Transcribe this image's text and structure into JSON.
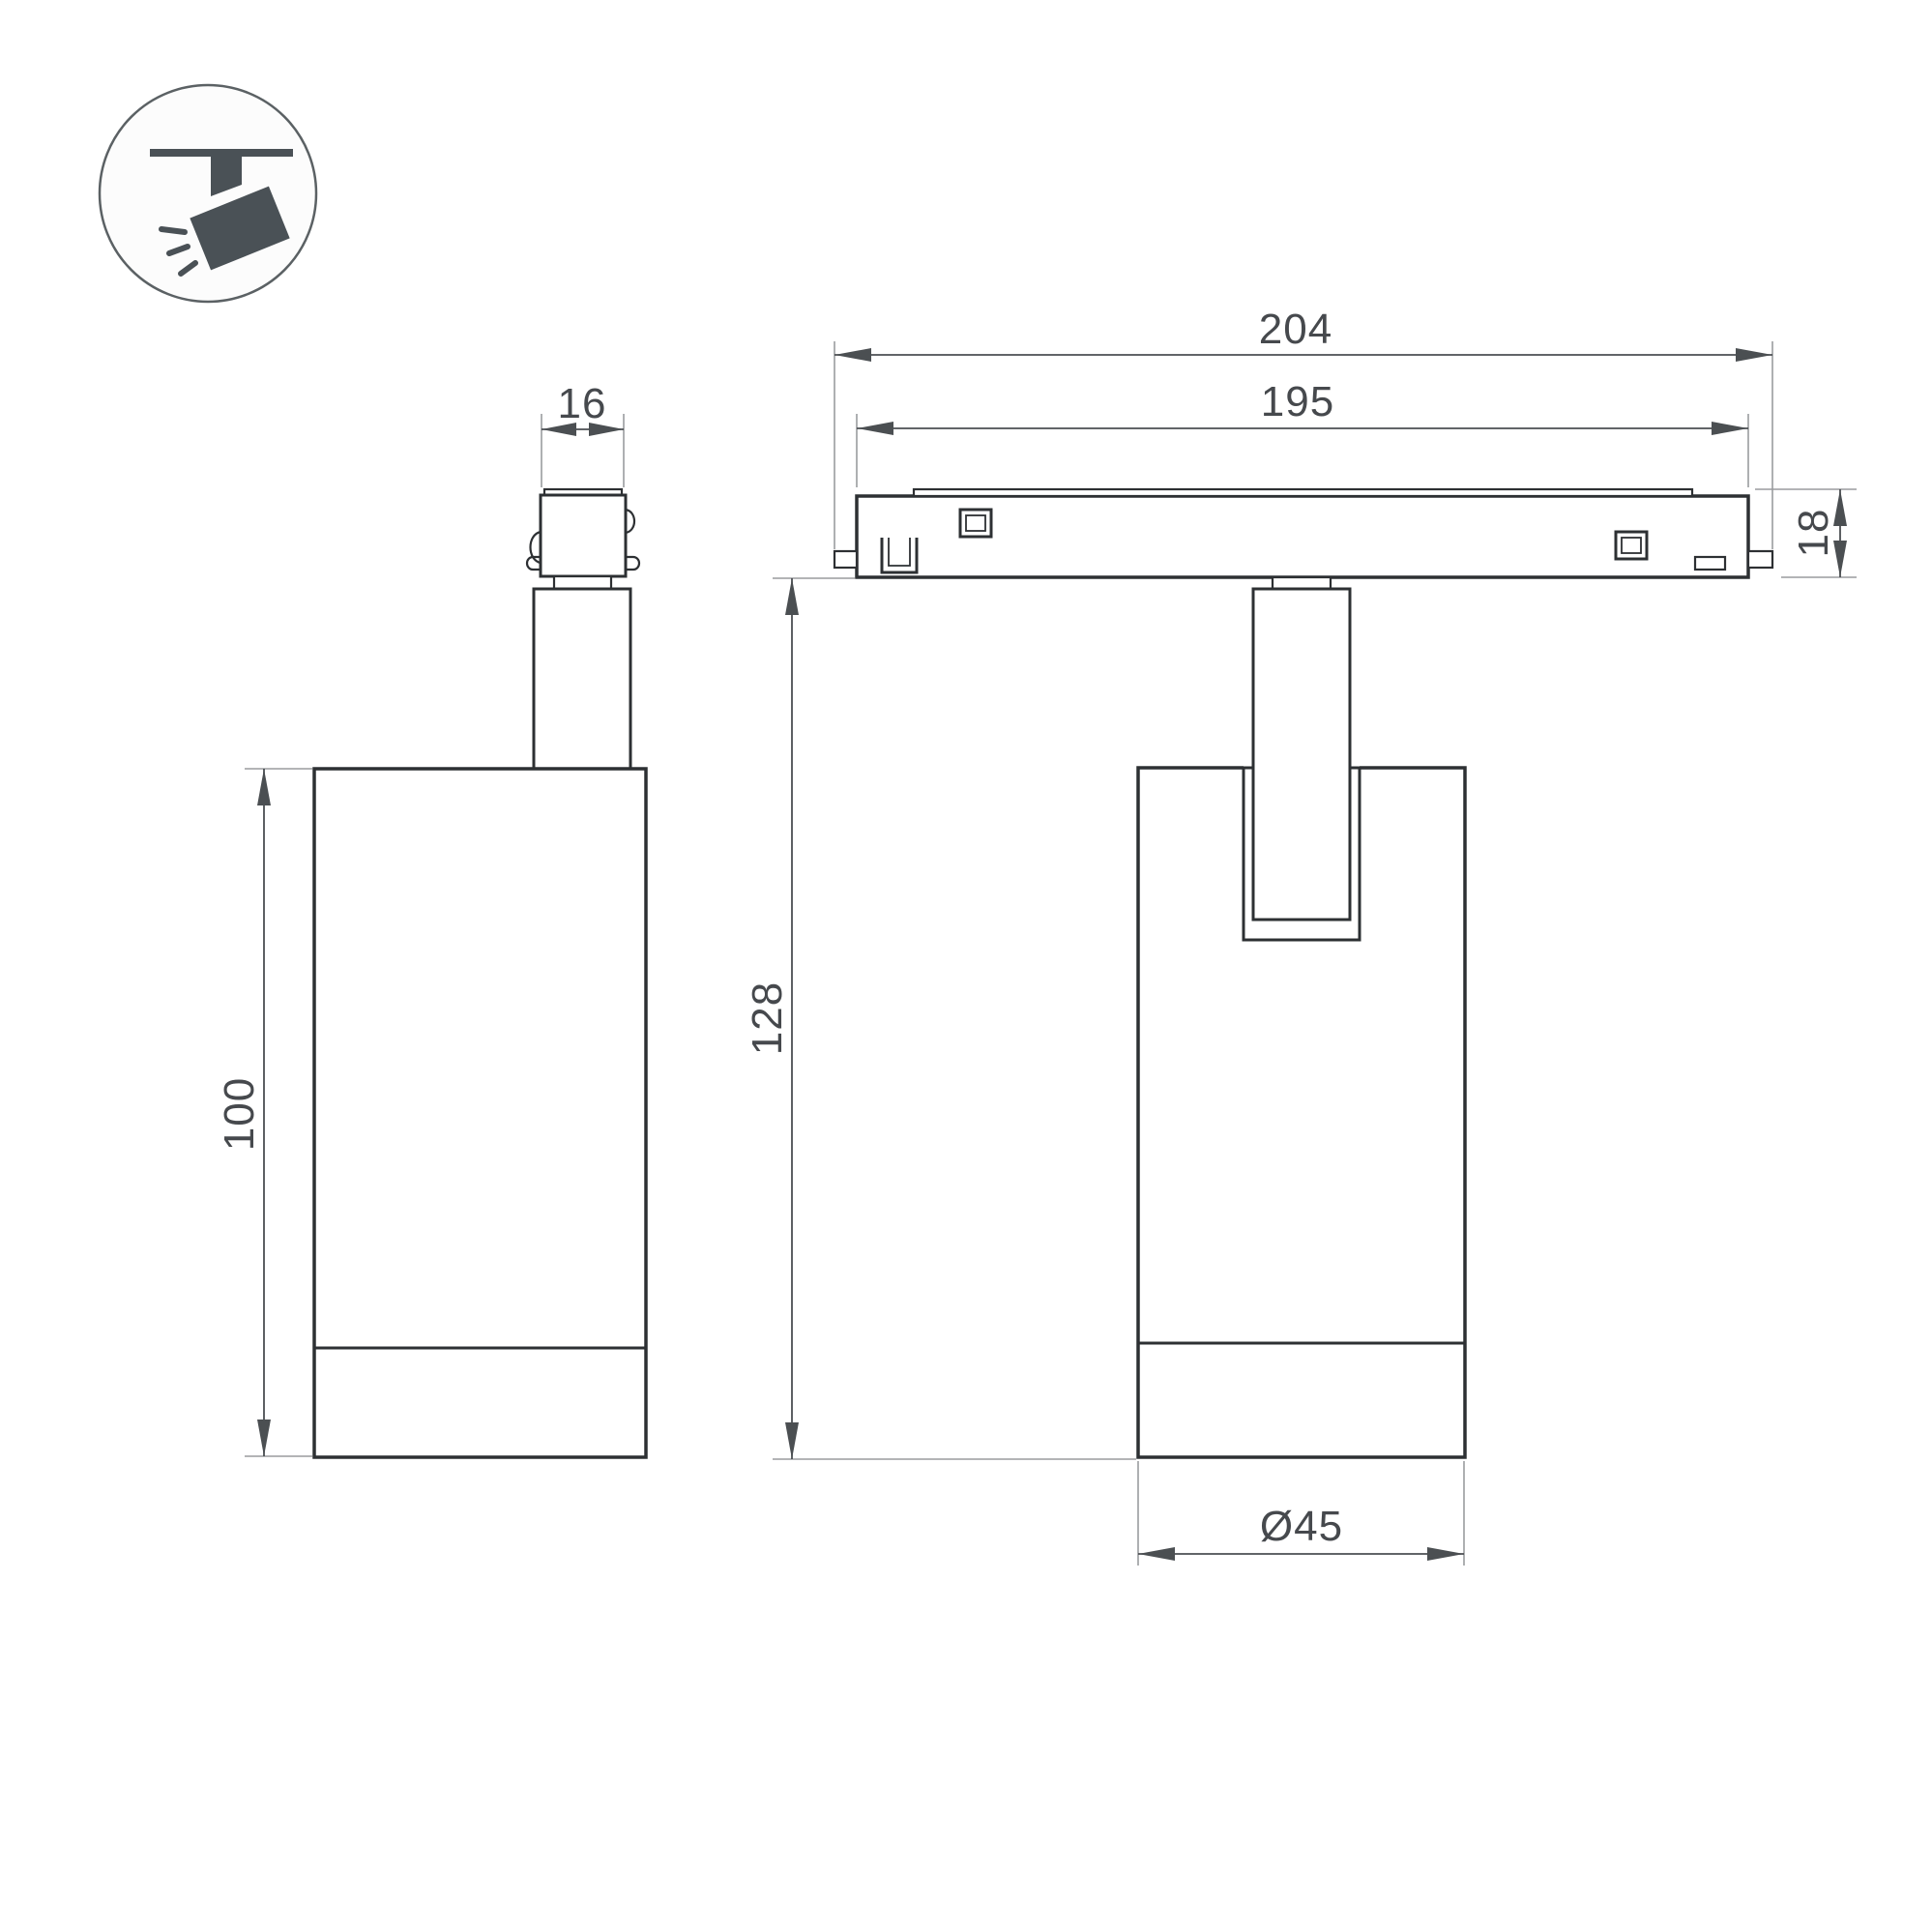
{
  "page": {
    "description": "Technical dimension drawing of a magnetic track spotlight shown in two orthographic views with a track-mount pictogram"
  },
  "icon": {
    "name": "track-spotlight-icon"
  },
  "dimensions": {
    "connector_width": "16",
    "track_total_length": "204",
    "track_body_length": "195",
    "track_height": "18",
    "overall_height": "128",
    "body_height": "100",
    "body_diameter": "Ø45"
  },
  "colors": {
    "outline": "#2d3033",
    "dim": "#4b4f52",
    "ext": "#9a9c9e",
    "text": "#46494d",
    "icon": "#4a5156",
    "background": "#ffffff"
  }
}
